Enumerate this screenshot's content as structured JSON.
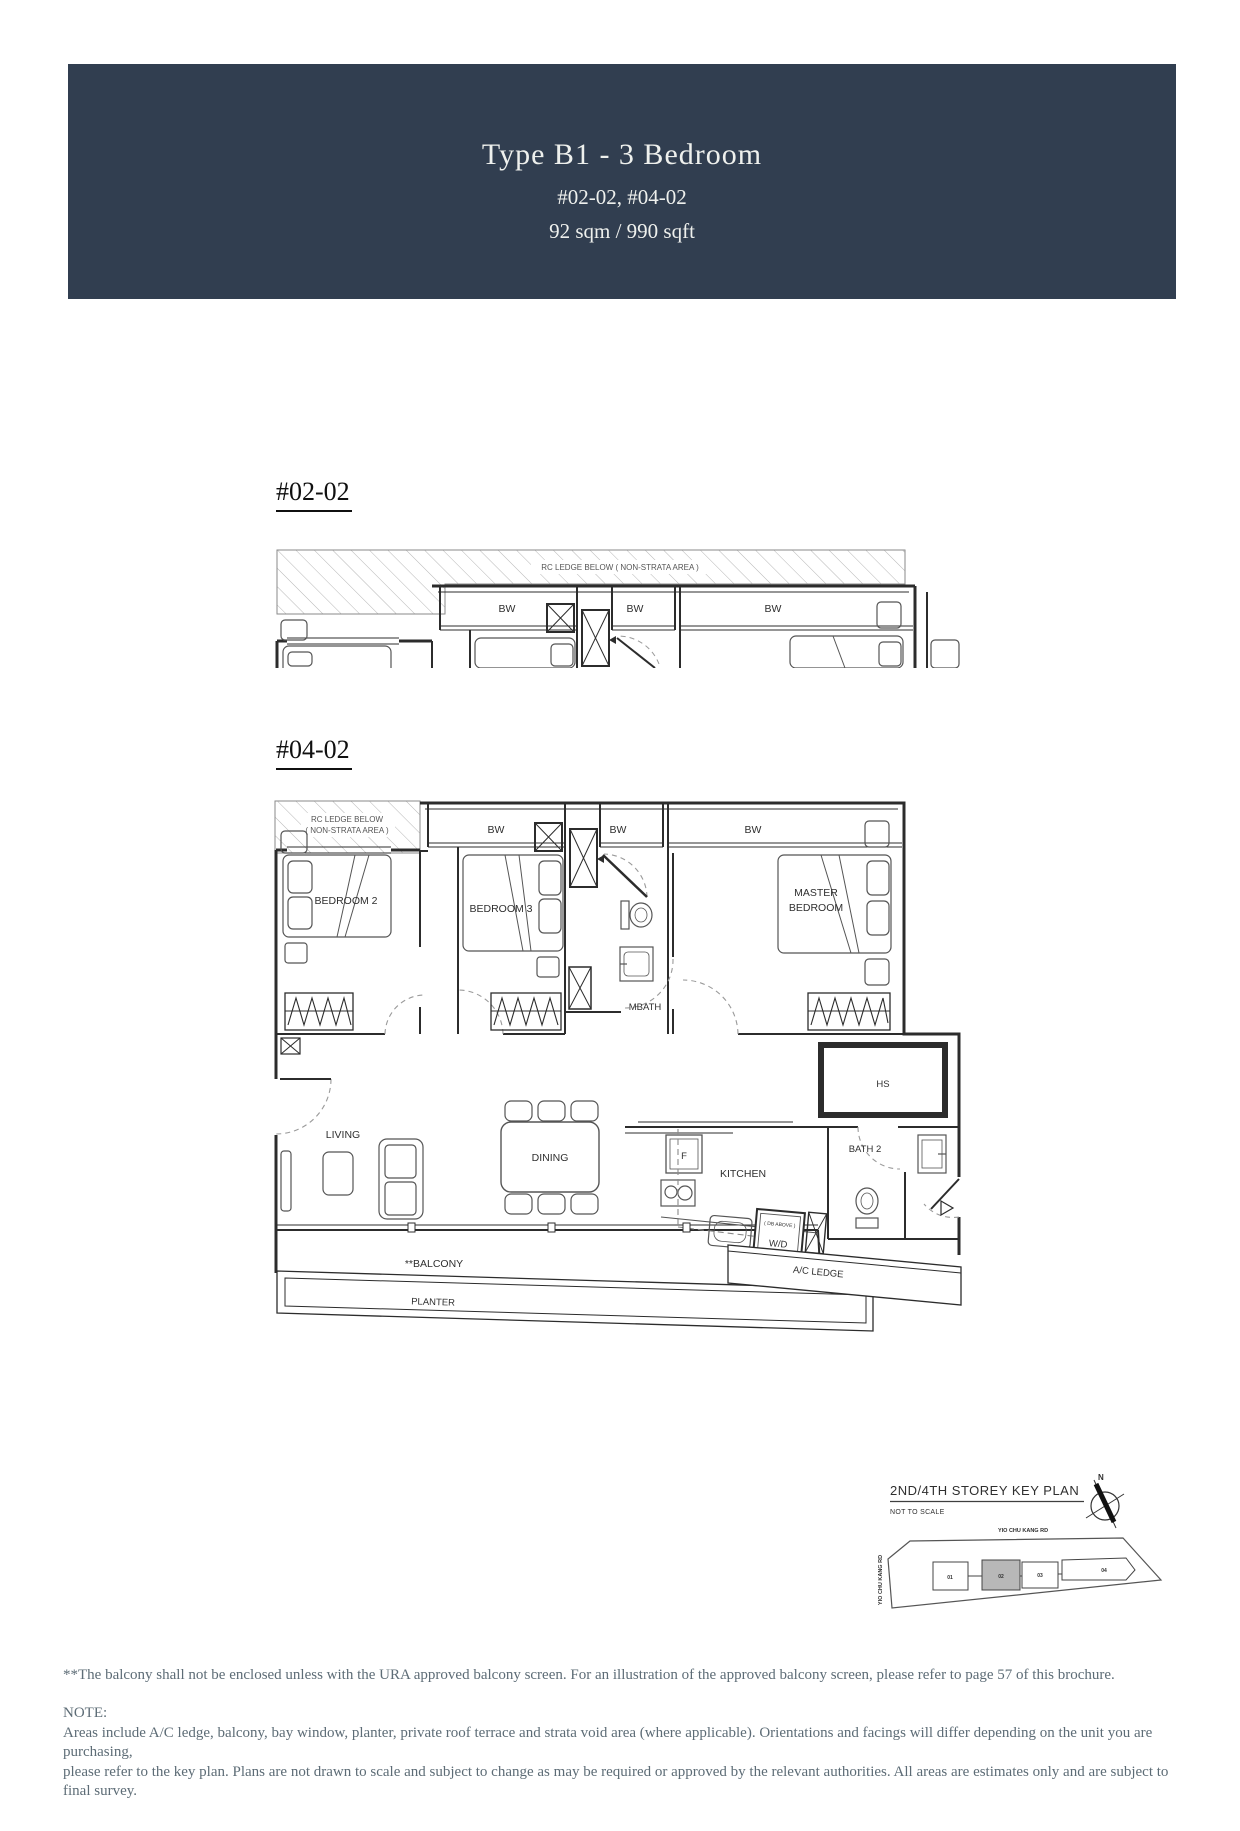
{
  "header": {
    "title": "Type B1 - 3 Bedroom",
    "units": "#02-02, #04-02",
    "area": "92 sqm / 990 sqft",
    "bg_color": "#313e50"
  },
  "plan1": {
    "label": "#02-02",
    "rc_ledge_note": "RC LEDGE BELOW ( NON-STRATA AREA )",
    "bw": [
      "BW",
      "BW",
      "BW"
    ]
  },
  "plan2": {
    "label": "#04-02",
    "rc_ledge_line1": "RC LEDGE BELOW",
    "rc_ledge_line2": "( NON-STRATA AREA )",
    "bw": [
      "BW",
      "BW",
      "BW"
    ],
    "bedroom2": "BEDROOM 2",
    "bedroom3": "BEDROOM 3",
    "master1": "MASTER",
    "master2": "BEDROOM",
    "mbath": "MBATH",
    "hs": "HS",
    "bath2": "BATH 2",
    "kitchen": "KITCHEN",
    "fridge": "F",
    "dining": "DINING",
    "living": "LIVING",
    "wd": "W/D",
    "db_above": "( DB ABOVE )",
    "balcony": "**BALCONY",
    "planter": "PLANTER",
    "ac_ledge": "A/C LEDGE"
  },
  "key_plan": {
    "title": "2ND/4TH STOREY KEY PLAN",
    "subtitle": "NOT TO SCALE",
    "north": "N",
    "road_top": "YIO CHU KANG RD",
    "road_left": "YIO CHU KANG RD",
    "blocks": [
      {
        "label": "01",
        "highlighted": false
      },
      {
        "label": "02",
        "highlighted": true
      },
      {
        "label": "03",
        "highlighted": false
      },
      {
        "label": "04",
        "highlighted": false
      }
    ]
  },
  "footnotes": {
    "balcony_note": "**The balcony shall not be enclosed unless with the URA approved balcony screen. For an illustration of the approved balcony screen, please refer to page 57 of this brochure.",
    "note_label": "NOTE:",
    "note_line1": "Areas include A/C ledge, balcony, bay window, planter, private roof terrace and strata void area (where applicable). Orientations and facings will differ depending on the unit you are purchasing,",
    "note_line2": "please refer to the key plan. Plans are not drawn to scale and subject to change as may be required or approved by the relevant authorities. All areas are estimates only and are subject to final survey."
  }
}
